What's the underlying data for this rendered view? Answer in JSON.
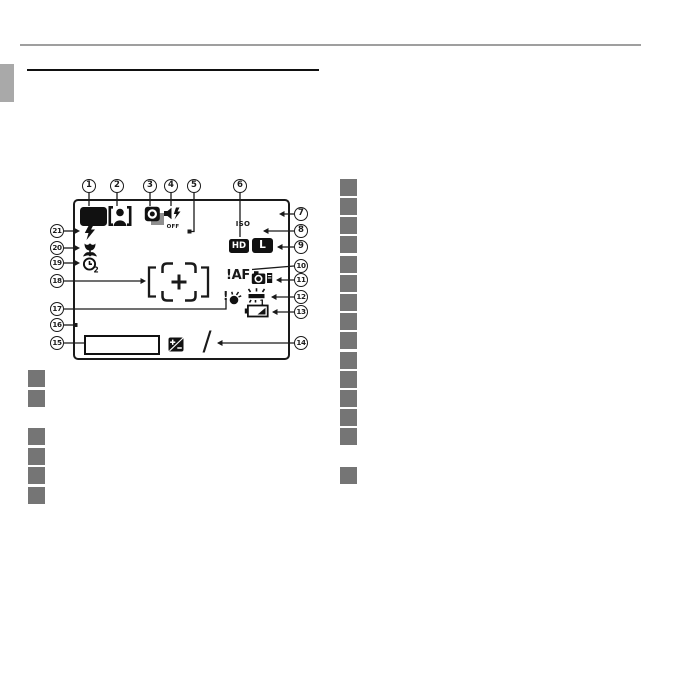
{
  "page_type": "camera-manual-lcd-diagram-page",
  "colors": {
    "line": "#1a1a1a",
    "placeholder_gray": "#757575",
    "edge_tab_gray": "#a9a9a9",
    "header_rule_gray": "#9f9f9f"
  },
  "callouts": [
    "1",
    "2",
    "3",
    "4",
    "5",
    "6",
    "7",
    "8",
    "9",
    "10",
    "11",
    "12",
    "13",
    "14",
    "15",
    "16",
    "17",
    "18",
    "19",
    "20",
    "21"
  ],
  "display": {
    "iso_label": "ISO",
    "hd_badge": "HD",
    "size_badge": "L",
    "af_warning": "!AF",
    "silent_off": "OFF",
    "fluorescent_no": "1",
    "timer_no": "2",
    "exposure_slash": "/"
  },
  "icons": {
    "shooting-mode-icon": "black-rounded-rect",
    "face-detection-icon": "brackets-with-person",
    "continuous-shooting-icon": "stacked-frames-ring",
    "silent-mode-icon": "speaker-bolt-off",
    "movie-quality-icon": "HD-badge",
    "image-size-icon": "L-badge",
    "af-warning-icon": "exclamation-AF",
    "internal-memory-icon": "camera-with-card",
    "white-balance-icon": "fluorescent-1",
    "battery-level-icon": "battery-gauge",
    "blur-warning-icon": "exclamation-blob-sparkle",
    "exposure-comp-icon": "plus-minus-diagonal-badge",
    "date-stamp-icon": "empty-rectangle",
    "focus-frame-icon": "corner-brackets-with-plus",
    "flash-mode-icon": "lightning-bolt",
    "macro-icon": "flower",
    "self-timer-icon": "clock-with-2"
  }
}
